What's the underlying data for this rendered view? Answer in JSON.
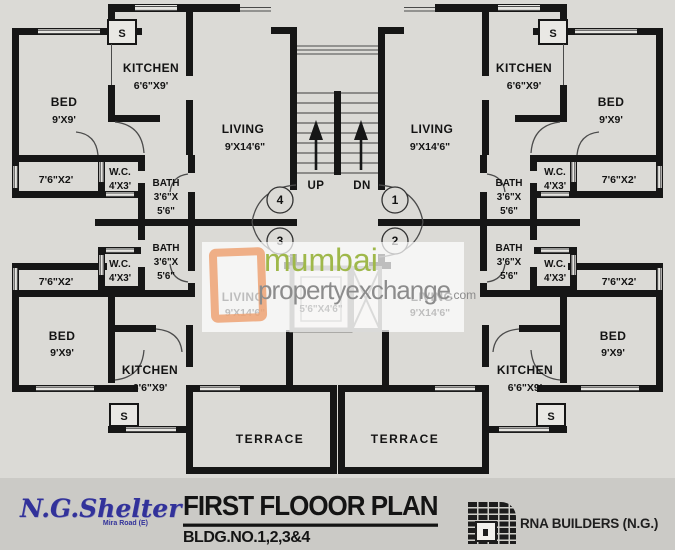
{
  "plan": {
    "title": "FIRST FLOOOR PLAN",
    "building": "BLDG.NO.1,2,3&4"
  },
  "branding": {
    "developer": "N.G.Shelter",
    "developer_location": "Mira Road (E)",
    "builder": "RNA BUILDERS (N.G.)"
  },
  "watermark": {
    "word1": "mumbai",
    "word2": "propertyexchange",
    "word3": ".com"
  },
  "stairs": {
    "up_label": "UP",
    "down_label": "DN"
  },
  "flats": {
    "flat1": "1",
    "flat2": "2",
    "flat3": "3",
    "flat4": "4"
  },
  "rooms": {
    "kitchen_name": "KITCHEN",
    "kitchen_size": "6'6\"X9'",
    "bed_name": "BED",
    "bed_size": "9'X9'",
    "living_name": "LIVING",
    "living_size": "9'X14'6\"",
    "wc_name": "W.C.",
    "wc_size": "4'X3'",
    "bath_name": "BATH",
    "bath_size_line1": "3'6\"X",
    "bath_size_line2": "5'6\"",
    "balcony_size": "7'6\"X2'",
    "terrace_name": "TERRACE",
    "shaft_label": "S",
    "lift_size": "5'6\"X4'6\""
  },
  "colors": {
    "wall": "#161616",
    "paper": "#dbdad6",
    "watermark_green": "#9fb84a",
    "watermark_gray": "#8c8c8c",
    "watermark_orange": "#eda273",
    "developer_blue": "#32329a"
  }
}
